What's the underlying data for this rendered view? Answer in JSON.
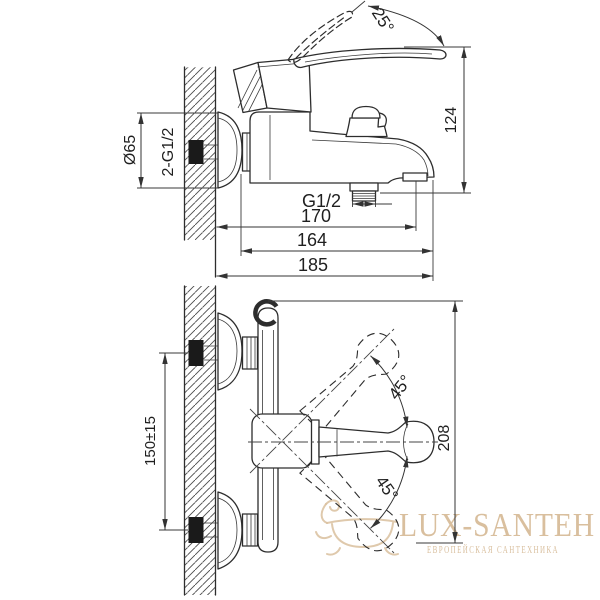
{
  "drawing": {
    "type": "technical-installation-drawing",
    "subject": "wall-mounted bath mixer faucet, side view and plan view with dimensions",
    "dims": {
      "angle_25": "25°",
      "h124": "124",
      "d65": "Ø65",
      "g12_pair": "2-G1/2",
      "g12": "G1/2",
      "l170": "170",
      "l164": "164",
      "l185": "185",
      "spacing150": "150±15",
      "angle45_up": "45°",
      "angle45_down": "45°",
      "h208": "208"
    },
    "colors": {
      "background": "#ffffff",
      "line": "#2d2d2d",
      "dimension": "#333333",
      "hatch": "#4a4a4a",
      "watermark": "#d9bf9e"
    }
  },
  "watermark": {
    "brand": "LUX-SANTEH",
    "tagline": "ЕВРОПЕЙСКАЯ САНТЕХНИКА",
    "logo_icon": "bathtub-icon"
  }
}
